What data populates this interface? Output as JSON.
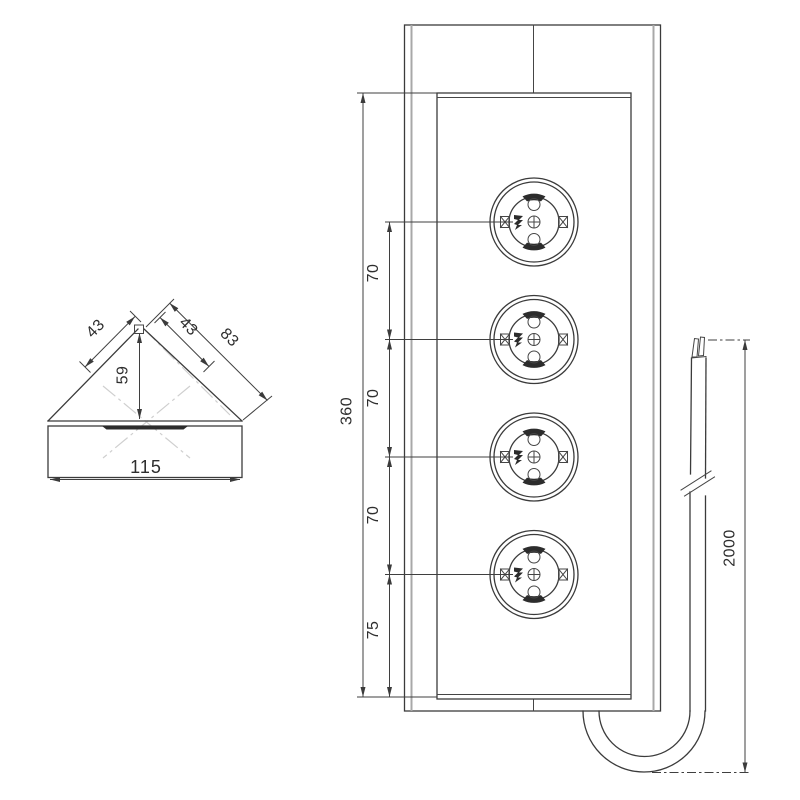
{
  "drawing": {
    "subject": "corner-socket-strip-technical-drawing",
    "colors": {
      "line": "#3b3b3b",
      "secondary_line": "#a8a8a8",
      "centerline": "#cfcfcf",
      "background": "#ffffff"
    },
    "dims": {
      "corner_view": {
        "left_face": "43",
        "right_face": "43",
        "outer_face": "83",
        "depth": "59",
        "width": "115"
      },
      "front_view": {
        "height": "360",
        "pitch1": "70",
        "pitch2": "70",
        "pitch3": "70",
        "bottom_offset": "75"
      },
      "cable": {
        "length": "2000"
      }
    }
  }
}
